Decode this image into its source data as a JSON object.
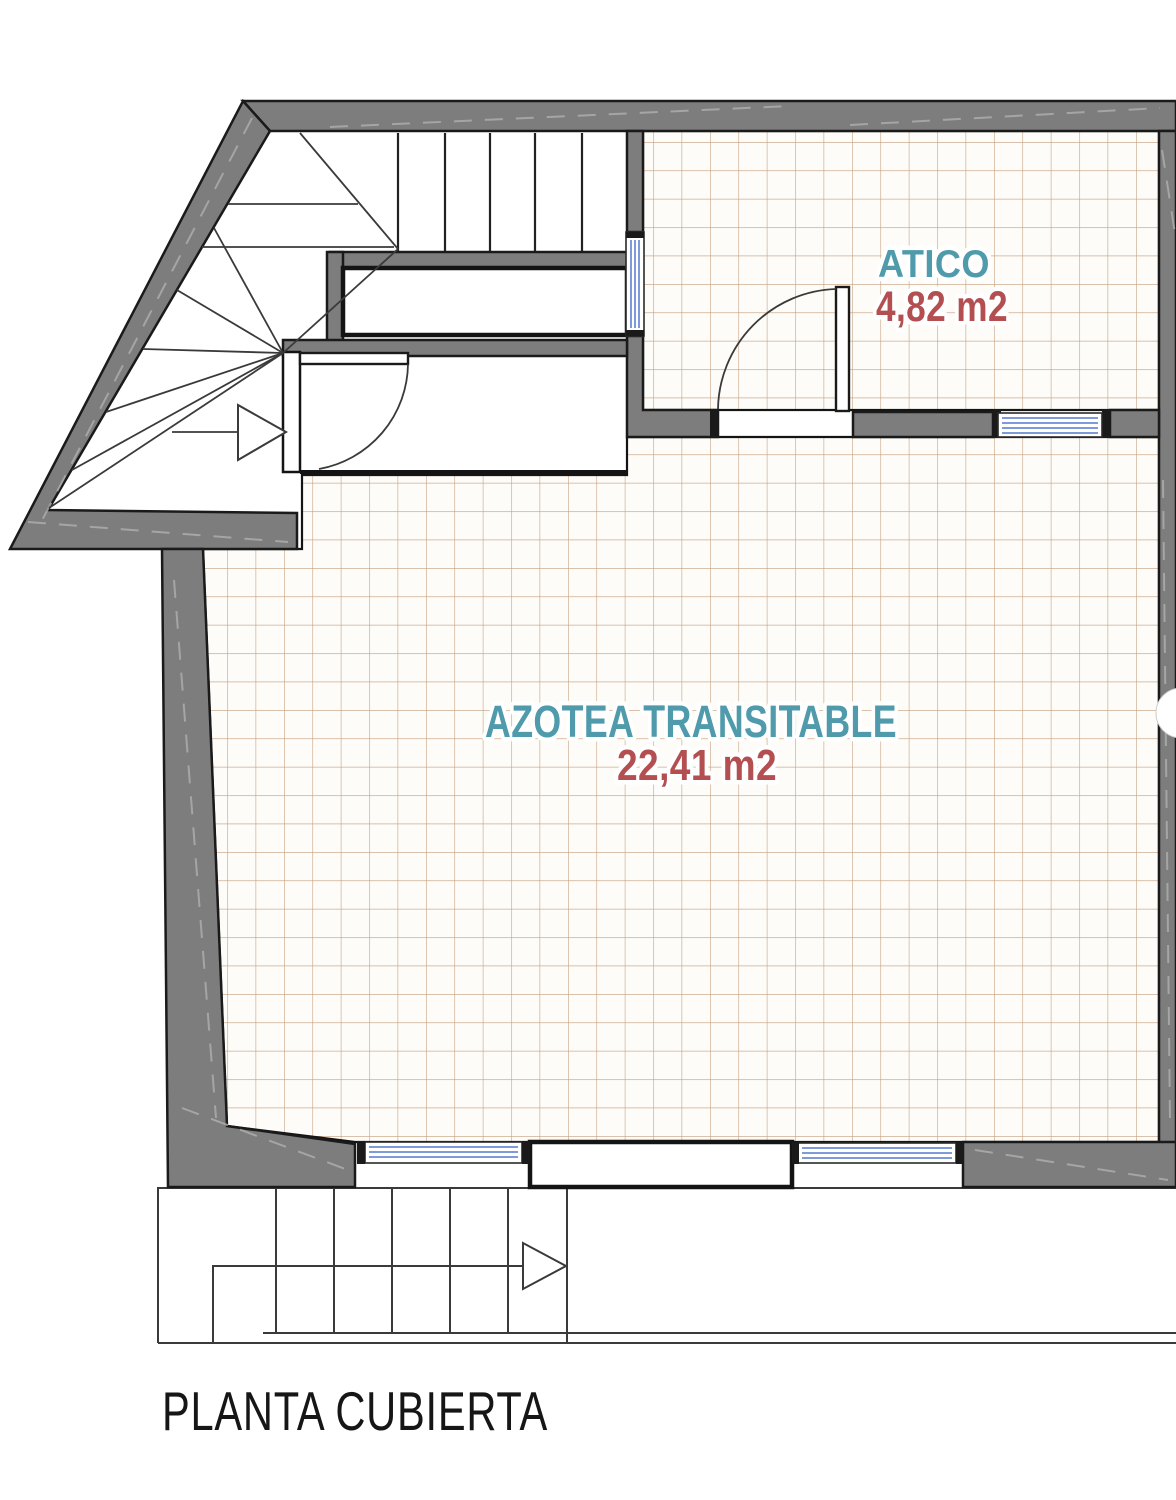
{
  "plan": {
    "title": "PLANTA CUBIERTA",
    "rooms": [
      {
        "name": "ATICO",
        "area": "4,82 m2"
      },
      {
        "name": "AZOTEA TRANSITABLE",
        "area": "22,41 m2"
      }
    ],
    "features": {
      "upper_stair_arrow": "stair-direction-arrow",
      "lower_stair_arrow": "stair-direction-arrow",
      "windows_count": "4",
      "doors_count": "2"
    }
  },
  "colors": {
    "room_name": "#4f9aab",
    "room_area": "#b34f51",
    "title": "#161616",
    "wall_fill": "#7d7d7d",
    "wall_edge": "#1a1a1a",
    "tile_line": "#c49e7d",
    "tile_fill": "#fdfcf8",
    "window_glass": "#7f9ad8"
  }
}
